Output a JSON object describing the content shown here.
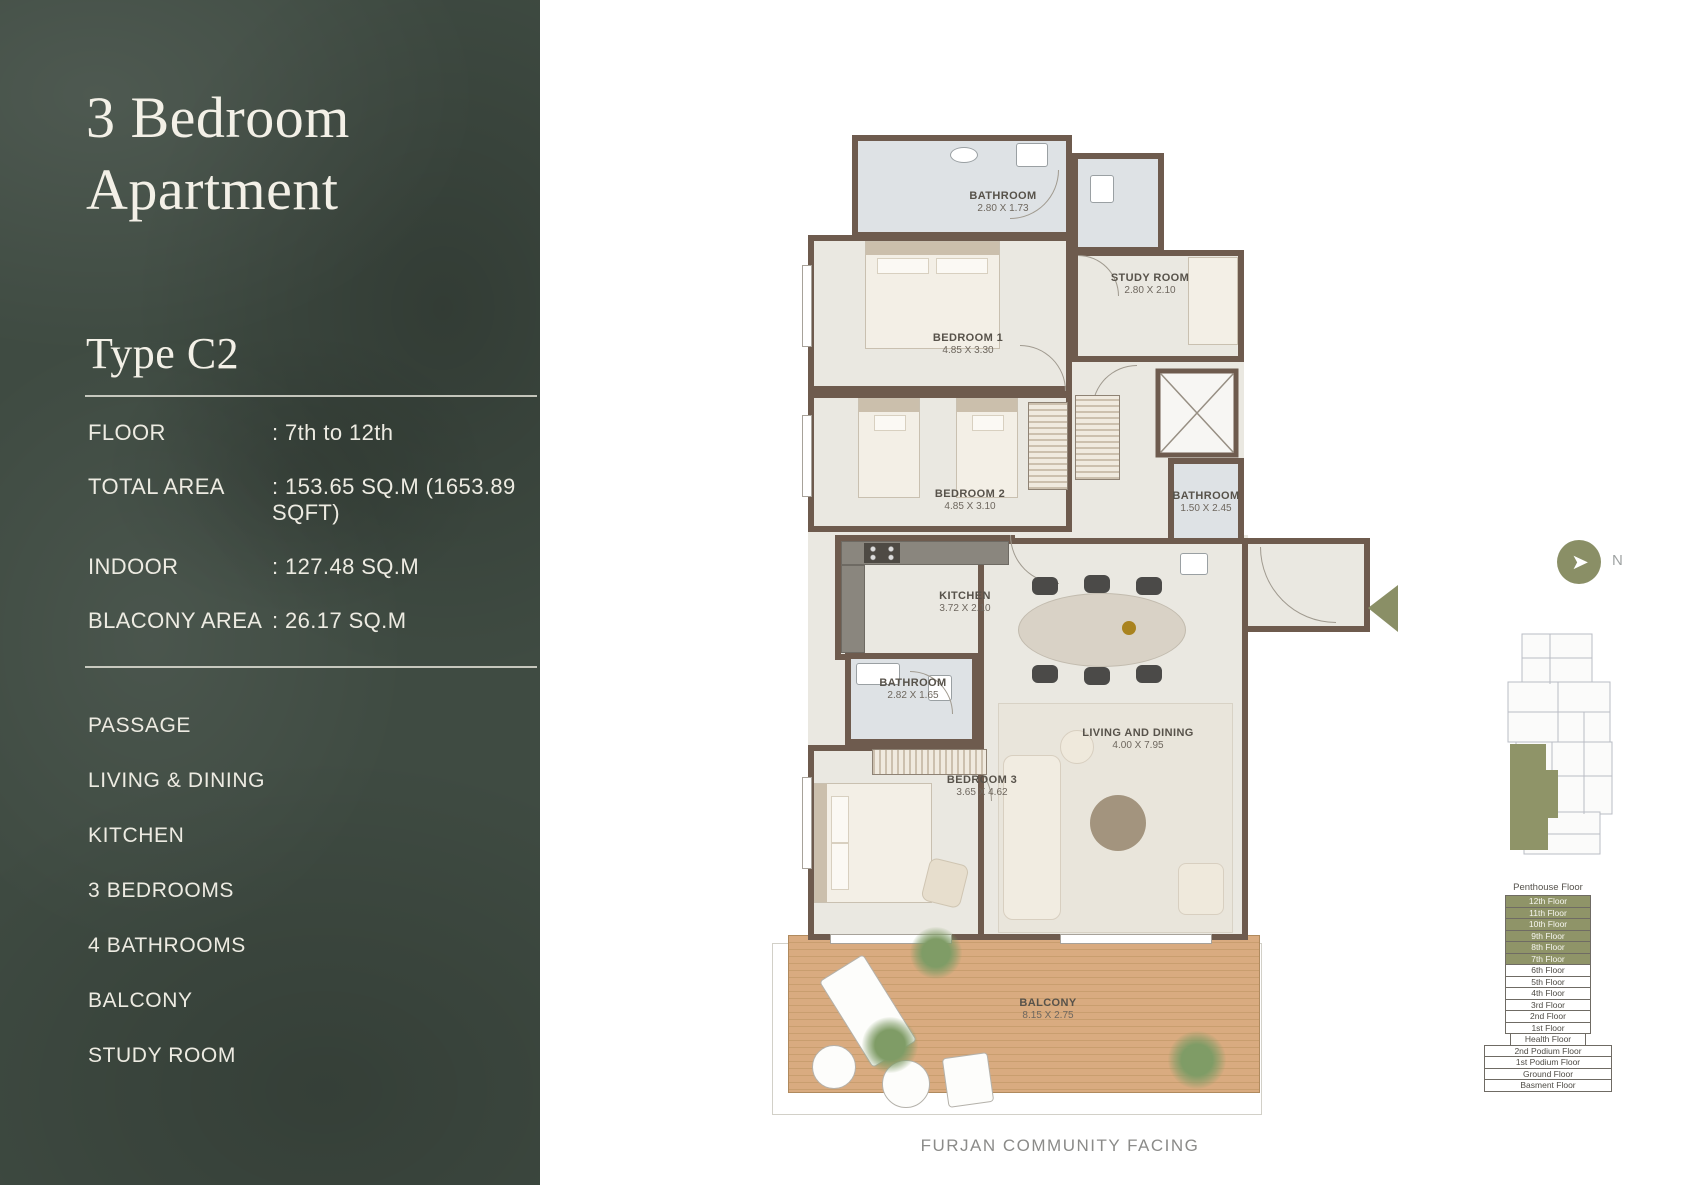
{
  "panel": {
    "title": "3 Bedroom Apartment",
    "type_label": "Type C2",
    "details": [
      {
        "label": "FLOOR",
        "value": ": 7th to 12th"
      },
      {
        "label": "TOTAL AREA",
        "value": ": 153.65 SQ.M (1653.89 SQFT)"
      },
      {
        "label": "INDOOR",
        "value": ": 127.48 SQ.M"
      },
      {
        "label": "BLACONY AREA",
        "value": ": 26.17 SQ.M"
      }
    ],
    "features": [
      "PASSAGE",
      "LIVING & DINING",
      "KITCHEN",
      "3 BEDROOMS",
      "4 BATHROOMS",
      "BALCONY",
      "STUDY ROOM"
    ]
  },
  "plan": {
    "rooms": [
      {
        "name": "BATHROOM",
        "dims": "2.80 X 1.73"
      },
      {
        "name": "STUDY ROOM",
        "dims": "2.80 X 2.10"
      },
      {
        "name": "BEDROOM 1",
        "dims": "4.85 X 3.30"
      },
      {
        "name": "BEDROOM 2",
        "dims": "4.85 X 3.10"
      },
      {
        "name": "BATHROOM",
        "dims": "1.50 X 2.45"
      },
      {
        "name": "KITCHEN",
        "dims": "3.72 X 2.10"
      },
      {
        "name": "BATHROOM",
        "dims": "2.82 X 1.65"
      },
      {
        "name": "BEDROOM 3",
        "dims": "3.65 X 4.62"
      },
      {
        "name": "LIVING AND DINING",
        "dims": "4.00 X 7.95"
      },
      {
        "name": "BALCONY",
        "dims": "8.15 X 2.75"
      }
    ],
    "caption": "FURJAN COMMUNITY FACING"
  },
  "compass": {
    "label": "N"
  },
  "floors": {
    "title": "Penthouse Floor",
    "tower": [
      {
        "label": "12th Floor",
        "highlighted": true
      },
      {
        "label": "11th Floor",
        "highlighted": true
      },
      {
        "label": "10th Floor",
        "highlighted": true
      },
      {
        "label": "9th Floor",
        "highlighted": true
      },
      {
        "label": "8th Floor",
        "highlighted": true
      },
      {
        "label": "7th Floor",
        "highlighted": true
      },
      {
        "label": "6th Floor",
        "highlighted": false
      },
      {
        "label": "5th Floor",
        "highlighted": false
      },
      {
        "label": "4th Floor",
        "highlighted": false
      },
      {
        "label": "3rd Floor",
        "highlighted": false
      },
      {
        "label": "2nd Floor",
        "highlighted": false
      },
      {
        "label": "1st Floor",
        "highlighted": false
      }
    ],
    "health": {
      "label": "Health Floor"
    },
    "podium": [
      {
        "label": "2nd Podium Floor"
      },
      {
        "label": "1st Podium Floor"
      },
      {
        "label": "Ground Floor"
      },
      {
        "label": "Basment Floor"
      }
    ]
  },
  "colors": {
    "accent_olive": "#8F9468",
    "wall_brown": "#6E5B4E",
    "panel_green": "#3F4B42",
    "deck_tan": "#D9AB80"
  }
}
